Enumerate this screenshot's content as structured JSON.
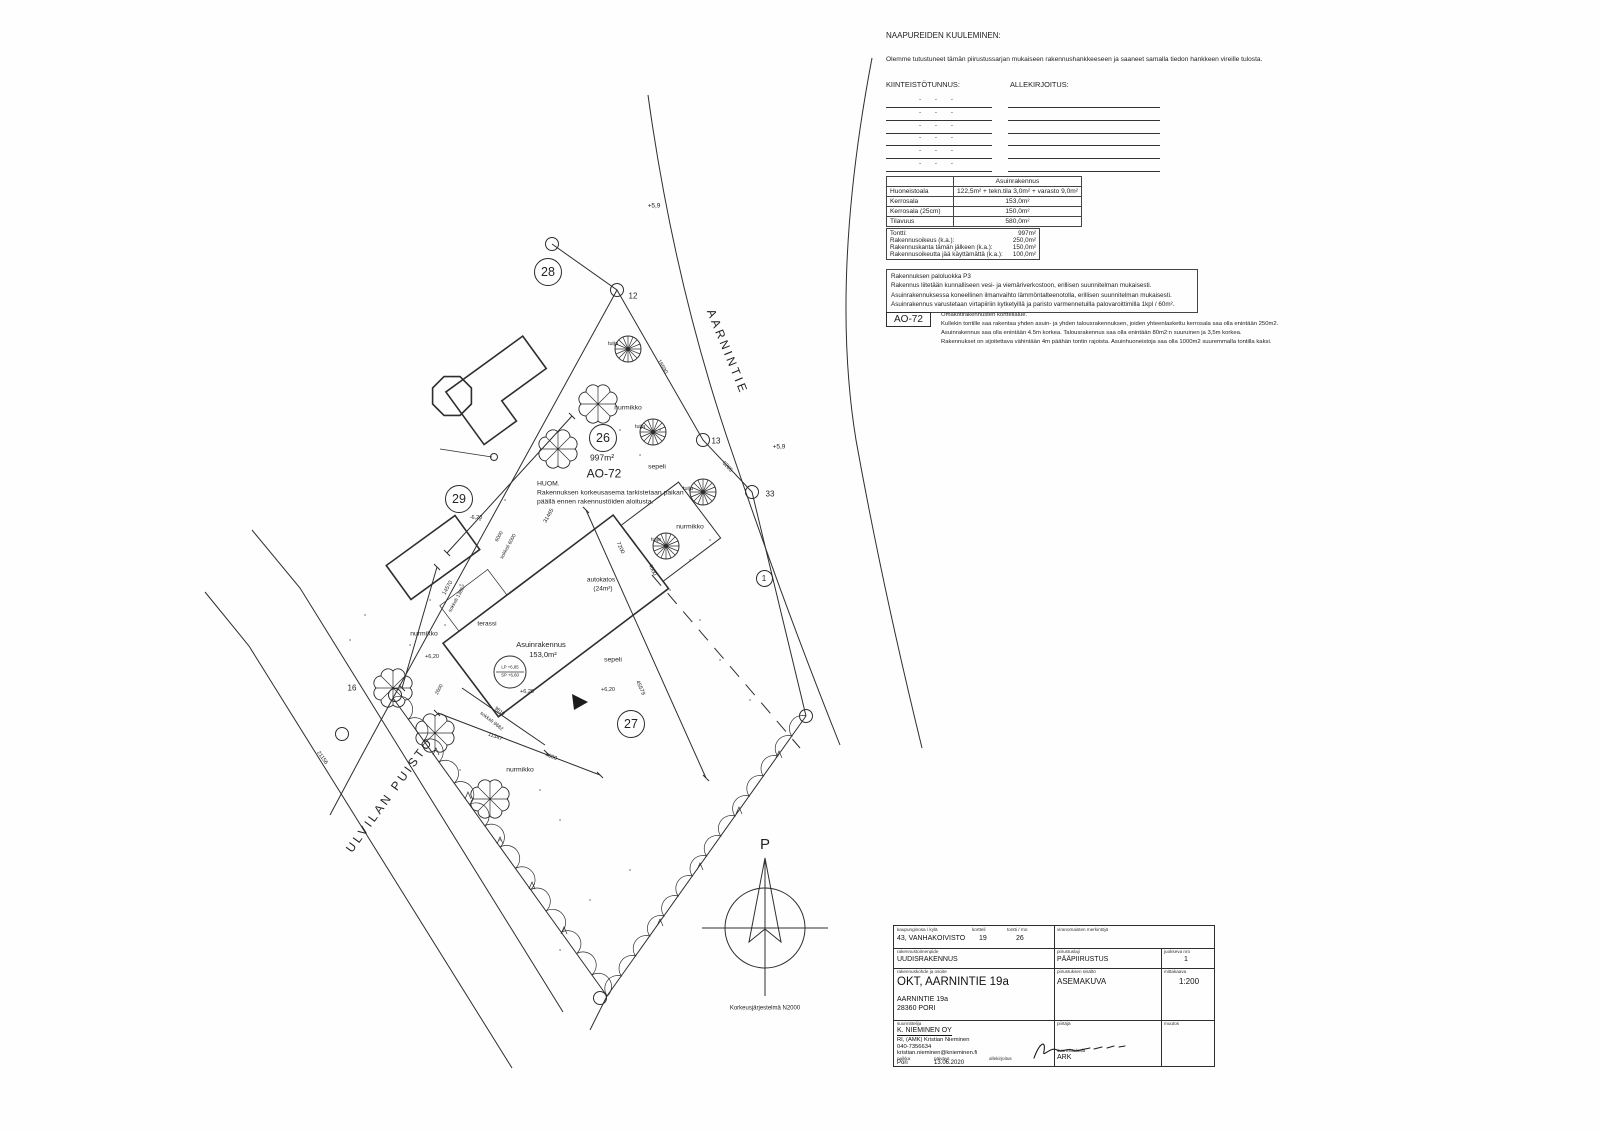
{
  "doc": {
    "neighbors": {
      "title": "NAAPUREIDEN KUULEMINEN:",
      "intro": "Olemme tutustuneet tämän piirustussarjan mukaiseen rakennushankkeeseen ja saaneet samalla tiedon hankkeen vireille tulosta.",
      "col1": "KIINTEISTÖTUNNUS:",
      "col2": "ALLEKIRJOITUS:",
      "rows": 6,
      "dashes": "-  -  -"
    },
    "area_table": {
      "header_col2": "Asuinrakennus",
      "rows": [
        {
          "label": "Huoneistoala",
          "value": "122,5m² + tekn.tila 3,0m² + varasto 9,0m²"
        },
        {
          "label": "Kerrosala",
          "value": "153,0m²"
        },
        {
          "label": "Kerrosala (25cm)",
          "value": "150,0m²"
        },
        {
          "label": "Tilavuus",
          "value": "580,0m²"
        }
      ]
    },
    "plot_table": {
      "rows": [
        {
          "label": "Tontti:",
          "value": "997m²"
        },
        {
          "label": "Rakennusoikeus (k.a.):",
          "value": "250,0m²"
        },
        {
          "label": "Rakennuskanta tämän jälkeen (k.a.):",
          "value": "150,0m²"
        },
        {
          "label": "Rakennusoikeutta jää käyttämättä (k.a.):",
          "value": "100,0m²"
        }
      ]
    },
    "notes": [
      "Rakennuksen paloluokka P3",
      "Rakennus liitetään kunnalliseen vesi- ja viemäriverkostoon, erillisen suunnitelman mukaisesti.",
      "Asuinrakennuksessa koneellinen ilmanvaihto lämmöntalteenotolla, erillisen suunnitelman mukaisesti.",
      "Asuinrakennus varustetaan virtapiiriin kytketyillä ja paristo varmennetuilla palovaroittimilla 1kpl / 60m²."
    ],
    "zoning": {
      "code": "AO-72",
      "lines": [
        "Omakotirakennusten korttelialue.",
        "Kullekin tontille saa rakentaa yhden asuin- ja yhden talousrakennuksen, joiden yhteenlaskettu kerrosala saa olla enintään 250m2.",
        "Asuinrakennus saa olla enintään 4.5m korkea. Talousrakennus saa olla enintään 80m2:n suuruinen ja 3,5m korkea.",
        "Rakennukset on sijoitettava vähintään 4m päähän tontin rajoista. Asuinhuoneistoja saa olla 1000m2 suuremmalla tontilla kaksi."
      ]
    }
  },
  "plan": {
    "circled": [
      {
        "t": "28",
        "x": 547,
        "y": 271
      },
      {
        "t": "29",
        "x": 458,
        "y": 498
      },
      {
        "t": "26",
        "x": 602,
        "y": 437
      },
      {
        "t": "27",
        "x": 630,
        "y": 723
      },
      {
        "t": "1",
        "x": 763,
        "y": 577,
        "small": true
      }
    ],
    "labels": [
      {
        "t": "AARNINTIE",
        "x": 727,
        "y": 352,
        "r": 68,
        "s": 12,
        "cls": "street"
      },
      {
        "t": "ULVILAN PUISTO",
        "x": 390,
        "y": 795,
        "r": -54,
        "s": 12,
        "cls": "street"
      },
      {
        "t": "997m²",
        "x": 602,
        "y": 458,
        "s": 8.5
      },
      {
        "t": "AO-72",
        "x": 604,
        "y": 474,
        "s": 12
      },
      {
        "t": "HUOM.",
        "x": 537,
        "y": 484,
        "s": 6.8,
        "a": "l"
      },
      {
        "t": "Rakennuksen korkeusasema tarkistetaan paikan",
        "x": 537,
        "y": 493,
        "s": 6.8,
        "a": "l"
      },
      {
        "t": "päällä ennen rakennustöiden aloitusta.",
        "x": 537,
        "y": 502,
        "s": 6.8,
        "a": "l"
      },
      {
        "t": "Asuinrakennus",
        "x": 541,
        "y": 645,
        "s": 7.5
      },
      {
        "t": "153,0m²",
        "x": 543,
        "y": 655,
        "s": 7.5
      },
      {
        "t": "autokatos",
        "x": 601,
        "y": 580,
        "s": 6.5
      },
      {
        "t": "(24m²)",
        "x": 603,
        "y": 589,
        "s": 6.5
      },
      {
        "t": "terassi",
        "x": 487,
        "y": 624,
        "s": 6.5
      },
      {
        "t": "sepeli",
        "x": 657,
        "y": 467,
        "s": 6.8
      },
      {
        "t": "sepeli",
        "x": 613,
        "y": 660,
        "s": 6.8
      },
      {
        "t": "nurmikko",
        "x": 628,
        "y": 408,
        "s": 6.8
      },
      {
        "t": "nurmikko",
        "x": 690,
        "y": 527,
        "s": 6.8
      },
      {
        "t": "nurmikko",
        "x": 424,
        "y": 634,
        "s": 6.8
      },
      {
        "t": "nurmikko",
        "x": 520,
        "y": 770,
        "s": 6.8
      },
      {
        "t": "tuija",
        "x": 613,
        "y": 344,
        "s": 5.5
      },
      {
        "t": "tuija",
        "x": 640,
        "y": 427,
        "s": 5.5
      },
      {
        "t": "tuija",
        "x": 688,
        "y": 489,
        "s": 5.5
      },
      {
        "t": "tuija",
        "x": 656,
        "y": 540,
        "s": 5.5
      },
      {
        "t": "+5,9",
        "x": 654,
        "y": 206,
        "s": 6.5
      },
      {
        "t": "+5,9",
        "x": 779,
        "y": 447,
        "s": 6.5
      },
      {
        "t": "+6,20",
        "x": 527,
        "y": 692,
        "s": 5.5
      },
      {
        "t": "+6,20",
        "x": 608,
        "y": 690,
        "s": 5.5
      },
      {
        "t": "-6,20",
        "x": 476,
        "y": 518,
        "s": 5.5
      },
      {
        "t": "+6,20",
        "x": 432,
        "y": 657,
        "s": 5.5
      },
      {
        "t": "12",
        "x": 633,
        "y": 297,
        "s": 8
      },
      {
        "t": "13",
        "x": 716,
        "y": 442,
        "s": 8
      },
      {
        "t": "33",
        "x": 770,
        "y": 495,
        "s": 8
      },
      {
        "t": "16",
        "x": 352,
        "y": 689,
        "s": 8
      },
      {
        "t": "16590",
        "x": 662,
        "y": 367,
        "r": 60,
        "s": 5.5
      },
      {
        "t": "6285",
        "x": 727,
        "y": 467,
        "r": 47,
        "s": 5.5
      },
      {
        "t": "45579",
        "x": 640,
        "y": 688,
        "r": 66,
        "s": 5.5
      },
      {
        "t": "21156",
        "x": 322,
        "y": 758,
        "r": 54,
        "s": 5.5
      },
      {
        "t": "31465",
        "x": 549,
        "y": 516,
        "r": -61,
        "s": 5.5
      },
      {
        "t": "14570",
        "x": 448,
        "y": 588,
        "r": -61,
        "s": 5.5
      },
      {
        "t": "sokkeli 13862",
        "x": 458,
        "y": 599,
        "r": -61,
        "s": 5
      },
      {
        "t": "6000",
        "x": 500,
        "y": 537,
        "r": -61,
        "s": 5
      },
      {
        "t": "sokkeli 6000",
        "x": 509,
        "y": 547,
        "r": -61,
        "s": 5
      },
      {
        "t": "7200",
        "x": 620,
        "y": 548,
        "r": 66,
        "s": 5.5
      },
      {
        "t": "4000",
        "x": 652,
        "y": 570,
        "r": 66,
        "s": 5.5
      },
      {
        "t": "9810",
        "x": 499,
        "y": 712,
        "r": 38,
        "s": 5
      },
      {
        "t": "sokkeli 9682",
        "x": 491,
        "y": 722,
        "r": 38,
        "s": 5
      },
      {
        "t": "11347",
        "x": 495,
        "y": 737,
        "r": 21,
        "s": 5.5
      },
      {
        "t": "4000",
        "x": 551,
        "y": 757,
        "r": 21,
        "s": 5.5
      },
      {
        "t": "2600",
        "x": 440,
        "y": 690,
        "r": -61,
        "s": 5
      },
      {
        "t": "LP +6,85",
        "x": 510,
        "y": 668,
        "s": 4.3
      },
      {
        "t": "SP +6,60",
        "x": 510,
        "y": 676,
        "s": 4.3
      },
      {
        "t": "P",
        "x": 765,
        "y": 845,
        "s": 15
      },
      {
        "t": "Korkeusjärjestelmä N2000",
        "x": 765,
        "y": 1009,
        "s": 6
      }
    ]
  },
  "title_block": {
    "r1": {
      "l1": "kaupunginosa / kylä",
      "l2": "kortteli",
      "l3": "tontti / rno",
      "v1": "43, VANHAKOIVISTO",
      "v2": "19",
      "v3": "26",
      "right": "viranomaisten merkintöjä"
    },
    "r2": {
      "l": "rakennustoimenpide",
      "v": "UUDISRAKENNUS",
      "pl": "piirustuslaji",
      "pv": "PÄÄPIIRUSTUS",
      "jl": "juokseva nro",
      "jv": "1"
    },
    "r3": {
      "l": "rakennuskohde ja osoite",
      "v": "OKT, AARNINTIE 19a",
      "a1": "AARNINTIE 19a",
      "a2": "28360 PORI",
      "sl": "piirustuksen sisältö",
      "sv": "ASEMAKUVA",
      "ml": "mittakaava",
      "mv": "1:200"
    },
    "r4": {
      "l": "suunnittelija",
      "company": "K. NIEMINEN OY",
      "person": "RI, (AMK) Kristian Nieminen",
      "phone": "040-7356634",
      "email": "kristian.nieminen@knieminen.fi",
      "pl": "paikka",
      "pv": "Pori",
      "dl": "päiväys",
      "dv": "13.06.2020",
      "sl": "allekirjoitus",
      "drl": "piirtäjä",
      "al": "suunnitteluala",
      "av": "ARK",
      "mul": "muutos"
    }
  }
}
